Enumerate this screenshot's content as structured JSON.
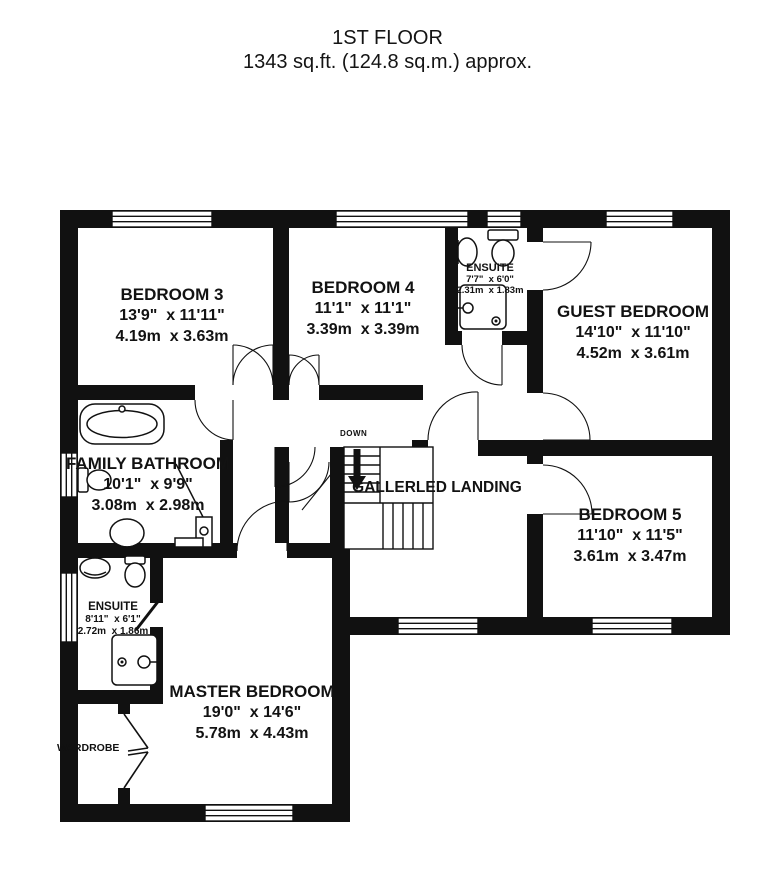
{
  "title": {
    "floor": "1ST FLOOR",
    "area": "1343 sq.ft. (124.8 sq.m.) approx."
  },
  "colors": {
    "wall": "#111111",
    "text": "#121212",
    "background": "#ffffff"
  },
  "stairs": {
    "down_label": "DOWN"
  },
  "rooms": {
    "bedroom3": {
      "name": "BEDROOM 3",
      "imperial": "13'9\"  x 11'11\"",
      "metric": "4.19m  x 3.63m"
    },
    "bedroom4": {
      "name": "BEDROOM 4",
      "imperial": "11'1\"  x 11'1\"",
      "metric": "3.39m  x 3.39m"
    },
    "ensuite_top": {
      "name": "ENSUITE",
      "imperial": "7'7\"  x 6'0\"",
      "metric": "2.31m  x 1.83m"
    },
    "guest_bedroom": {
      "name": "GUEST BEDROOM",
      "imperial": "14'10\"  x 11'10\"",
      "metric": "4.52m  x 3.61m"
    },
    "family_bathroom": {
      "name": "FAMILY BATHROOM",
      "imperial": "10'1\"  x 9'9\"",
      "metric": "3.08m  x 2.98m"
    },
    "landing": {
      "name": "GALLERLED LANDING"
    },
    "bedroom5": {
      "name": "BEDROOM 5",
      "imperial": "11'10\"  x 11'5\"",
      "metric": "3.61m  x 3.47m"
    },
    "ensuite_lower": {
      "name": "ENSUITE",
      "imperial": "8'11\"  x 6'1\"",
      "metric": "2.72m  x 1.86m"
    },
    "master_bedroom": {
      "name": "MASTER BEDROOM",
      "imperial": "19'0\"  x 14'6\"",
      "metric": "5.78m  x 4.43m"
    },
    "wardrobe": {
      "name": "WARDROBE"
    }
  }
}
